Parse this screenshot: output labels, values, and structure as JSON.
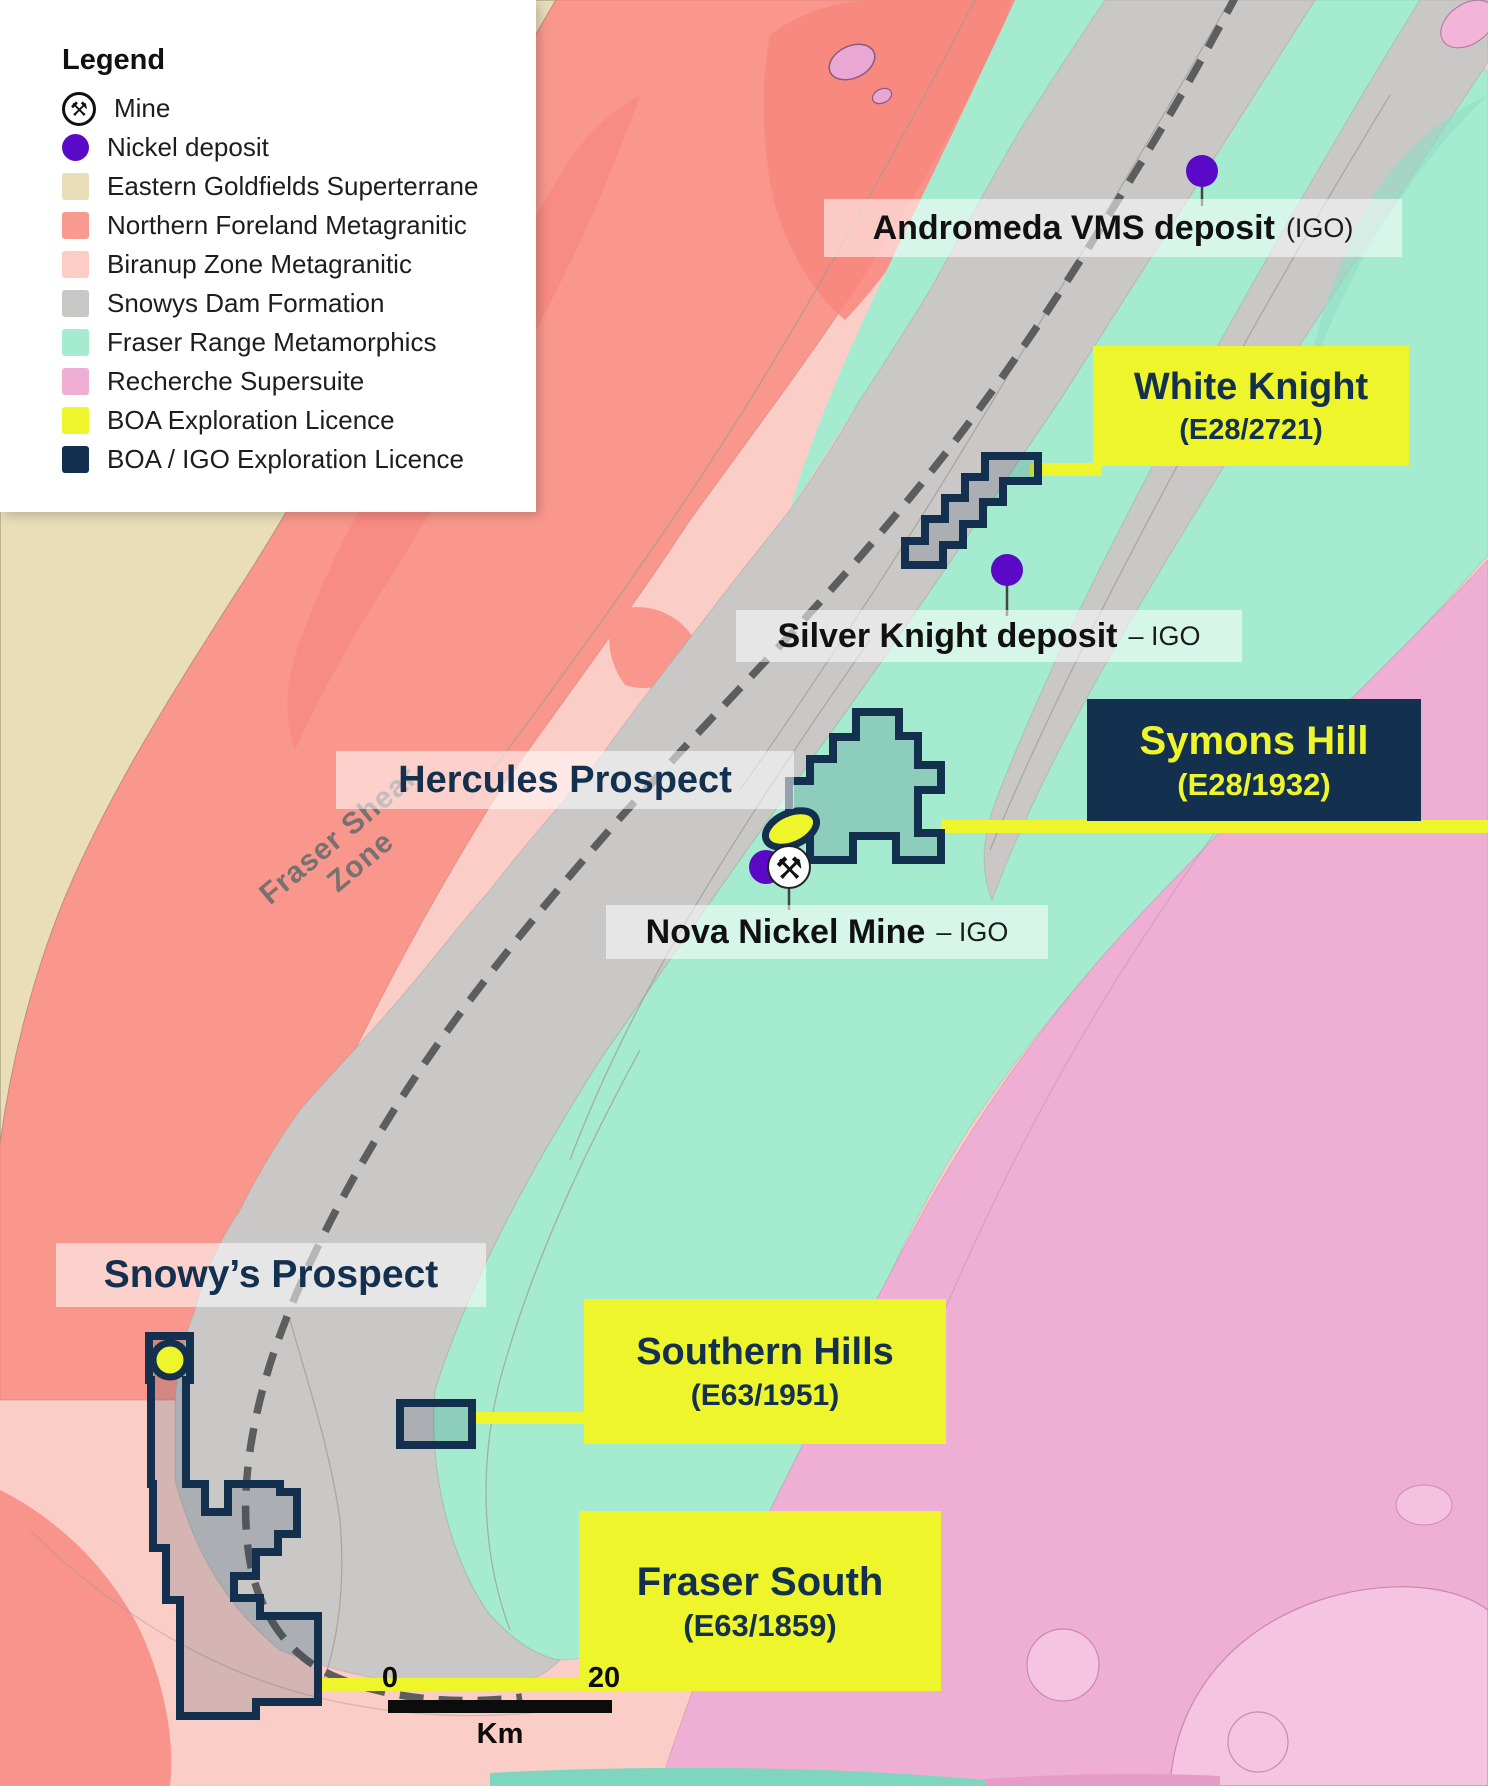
{
  "legend": {
    "title": "Legend",
    "items": [
      {
        "label": "Mine",
        "type": "mine"
      },
      {
        "label": "Nickel deposit",
        "type": "dot",
        "color": "#5A0AC6"
      },
      {
        "label": "Eastern Goldfields Superterrane",
        "type": "swatch",
        "color": "#E9DDBA"
      },
      {
        "label": "Northern Foreland Metagranitic",
        "type": "swatch",
        "color": "#F99A90"
      },
      {
        "label": "Biranup Zone Metagranitic",
        "type": "swatch",
        "color": "#FCCCC5"
      },
      {
        "label": "Snowys Dam Formation",
        "type": "swatch",
        "color": "#C8C7C6"
      },
      {
        "label": "Fraser Range Metamorphics",
        "type": "swatch",
        "color": "#A5EBD0"
      },
      {
        "label": "Recherche Supersuite",
        "type": "swatch",
        "color": "#EFAED4"
      },
      {
        "label": "BOA Exploration Licence",
        "type": "swatch",
        "color": "#EEF62B"
      },
      {
        "label": "BOA / IGO Exploration Licence",
        "type": "swatch",
        "color": "#13304E"
      }
    ]
  },
  "map": {
    "shear_zone_label": "Fraser Shear Zone",
    "labels": {
      "andromeda": {
        "name": "Andromeda VMS deposit",
        "suffix": "(IGO)"
      },
      "white_knight": {
        "name": "White Knight",
        "tenement": "(E28/2721)"
      },
      "silver_knight": {
        "name": "Silver Knight deposit",
        "suffix": "– IGO"
      },
      "hercules": {
        "name": "Hercules Prospect"
      },
      "symons_hill": {
        "name": "Symons Hill",
        "tenement": "(E28/1932)"
      },
      "nova": {
        "name": "Nova Nickel Mine",
        "suffix": "– IGO"
      },
      "snowys": {
        "name": "Snowy’s Prospect"
      },
      "southern_hills": {
        "name": "Southern Hills",
        "tenement": "(E63/1951)"
      },
      "fraser_south": {
        "name": "Fraser South",
        "tenement": "(E63/1859)"
      }
    }
  },
  "icons": {
    "mine_glyph": "⚒"
  },
  "scale_bar": {
    "start": "0",
    "end": "20",
    "unit": "Km"
  },
  "colors": {
    "boa_yellow": "#EEF62B",
    "licence_navy": "#13304E",
    "nickel_purple": "#5A0AC6",
    "shear_dash_gray": "#5D5D5D"
  }
}
